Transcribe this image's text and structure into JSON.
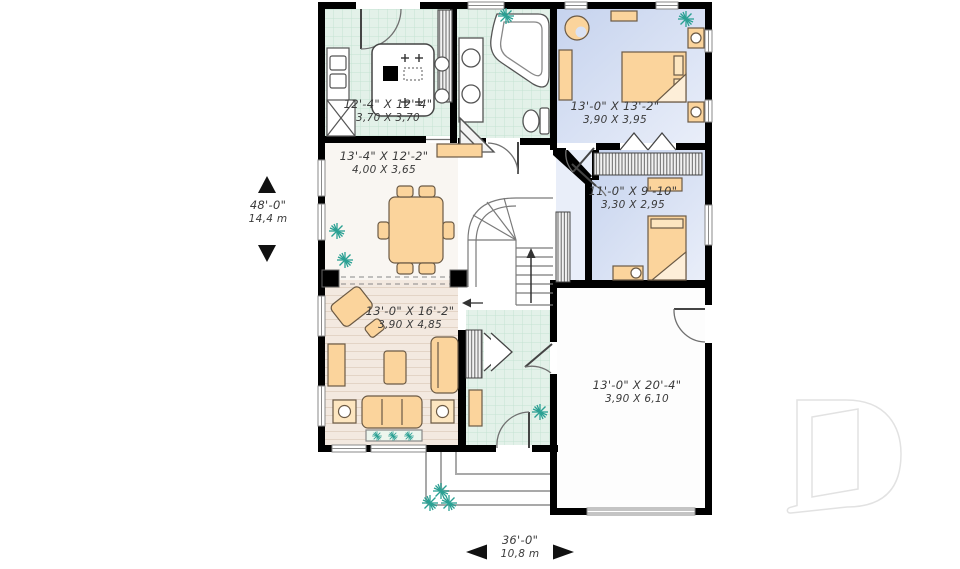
{
  "rooms": {
    "kitchen": {
      "imperial": "12'-4\" X 12'-4\"",
      "metric": "3,70 X 3,70"
    },
    "dining": {
      "imperial": "13'-4\" X 12'-2\"",
      "metric": "4,00 X 3,65"
    },
    "master_bedroom": {
      "imperial": "13'-0\" X 13'-2\"",
      "metric": "3,90 X 3,95"
    },
    "bedroom_2": {
      "imperial": "11'-0\" X 9'-10\"",
      "metric": "3,30 X 2,95"
    },
    "living_room": {
      "imperial": "13'-0\" X 16'-2\"",
      "metric": "3,90 X 4,85"
    },
    "garage": {
      "imperial": "13'-0\" X 20'-4\"",
      "metric": "3,90 X 6,10"
    }
  },
  "dimensions": {
    "depth": {
      "imperial": "48'-0\"",
      "metric": "14,4 m"
    },
    "width": {
      "imperial": "36'-0\"",
      "metric": "10,8 m"
    }
  },
  "logo": {
    "letter": "D"
  },
  "colors": {
    "wall": "#000000",
    "tile_floor": "#e3f1e9",
    "tile_grid": "#c2e0d2",
    "bedroom_floor": "#cdd9f0",
    "wood_floor": "#f3e9e0",
    "dining_floor": "#f9f6f2",
    "garage_floor": "#fdfdfd",
    "furniture": "#fbd49c",
    "furniture_light": "#fde6c0",
    "plant": "#2aa093",
    "logo_outline": "#e2e2e2",
    "dimension_text": "#3a3a3a"
  }
}
